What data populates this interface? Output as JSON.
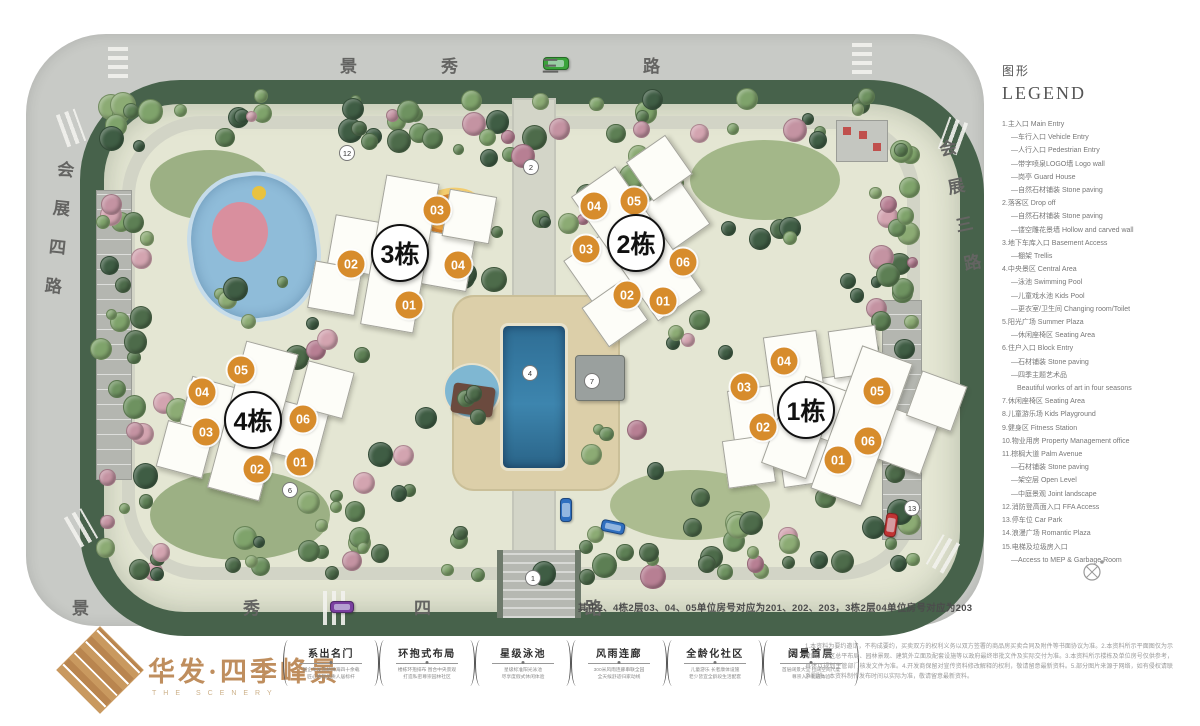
{
  "colors": {
    "road_gray": "#c8cac6",
    "tree_band_green": "#47624b",
    "ground": "#e4e6d3",
    "unit_orange": "#d78c2c",
    "pool_blue": "#2e6d94",
    "brand_gold": "#bf8e5e"
  },
  "map": {
    "roads": {
      "top": [
        "景",
        "秀",
        "三",
        "路"
      ],
      "bottom": [
        "景",
        "秀",
        "四",
        "路"
      ],
      "left": "会展四路",
      "right": "会展三路"
    },
    "note": "其中2、4栋2层03、04、05单位房号对应为201、202、203，3栋2层04单位房号对应为203",
    "buildings": [
      {
        "name": "3栋",
        "x": 400,
        "y": 253,
        "units": [
          {
            "n": "03",
            "x": 437,
            "y": 210
          },
          {
            "n": "02",
            "x": 351,
            "y": 264
          },
          {
            "n": "04",
            "x": 458,
            "y": 265
          },
          {
            "n": "01",
            "x": 409,
            "y": 305
          }
        ]
      },
      {
        "name": "2栋",
        "x": 636,
        "y": 243,
        "units": [
          {
            "n": "04",
            "x": 594,
            "y": 206
          },
          {
            "n": "05",
            "x": 634,
            "y": 201
          },
          {
            "n": "03",
            "x": 586,
            "y": 249
          },
          {
            "n": "06",
            "x": 683,
            "y": 262
          },
          {
            "n": "02",
            "x": 627,
            "y": 295
          },
          {
            "n": "01",
            "x": 663,
            "y": 301
          }
        ]
      },
      {
        "name": "1栋",
        "x": 806,
        "y": 410,
        "units": [
          {
            "n": "04",
            "x": 784,
            "y": 361
          },
          {
            "n": "03",
            "x": 744,
            "y": 387
          },
          {
            "n": "05",
            "x": 877,
            "y": 391
          },
          {
            "n": "02",
            "x": 763,
            "y": 427
          },
          {
            "n": "06",
            "x": 868,
            "y": 441
          },
          {
            "n": "01",
            "x": 838,
            "y": 460
          }
        ]
      },
      {
        "name": "4栋",
        "x": 253,
        "y": 420,
        "units": [
          {
            "n": "05",
            "x": 241,
            "y": 370
          },
          {
            "n": "04",
            "x": 202,
            "y": 392
          },
          {
            "n": "06",
            "x": 303,
            "y": 419
          },
          {
            "n": "03",
            "x": 206,
            "y": 432
          },
          {
            "n": "02",
            "x": 257,
            "y": 469
          },
          {
            "n": "01",
            "x": 300,
            "y": 462
          }
        ]
      }
    ],
    "path_markers": [
      {
        "n": "12",
        "x": 347,
        "y": 153
      },
      {
        "n": "2",
        "x": 531,
        "y": 167
      },
      {
        "n": "4",
        "x": 530,
        "y": 373
      },
      {
        "n": "7",
        "x": 592,
        "y": 381
      },
      {
        "n": "6",
        "x": 290,
        "y": 490
      },
      {
        "n": "1",
        "x": 533,
        "y": 578
      },
      {
        "n": "13",
        "x": 912,
        "y": 508
      }
    ]
  },
  "legend": {
    "title_zh": "图形",
    "title_en": "LEGEND",
    "lines": [
      {
        "t": "1.主入口 Main Entry",
        "l": 0
      },
      {
        "t": "—车行入口 Vehicle Entry",
        "l": 1
      },
      {
        "t": "—人行入口 Pedestrian Entry",
        "l": 1
      },
      {
        "t": "—带字喷泉LOGO墙 Logo wall",
        "l": 1
      },
      {
        "t": "—岗亭 Guard House",
        "l": 1
      },
      {
        "t": "—自然石材铺装 Stone paving",
        "l": 1
      },
      {
        "t": "2.落客区 Drop off",
        "l": 0
      },
      {
        "t": "—自然石材铺装 Stone paving",
        "l": 1
      },
      {
        "t": "—镂空雕花景墙 Hollow and carved wall",
        "l": 1
      },
      {
        "t": "3.地下车库入口 Basement Access",
        "l": 0
      },
      {
        "t": "—棚架 Trellis",
        "l": 1
      },
      {
        "t": "4.中央景区 Central Area",
        "l": 0
      },
      {
        "t": "—泳池 Swimming Pool",
        "l": 1
      },
      {
        "t": "—儿童戏水池 Kids Pool",
        "l": 1
      },
      {
        "t": "—更衣室/卫生间 Changing room/Toilet",
        "l": 1
      },
      {
        "t": "5.阳光广场 Summer Plaza",
        "l": 0
      },
      {
        "t": "—休闲座椅区 Seating Area",
        "l": 1
      },
      {
        "t": "6.住户入口 Block Entry",
        "l": 0
      },
      {
        "t": "—石材铺装 Stone paving",
        "l": 1
      },
      {
        "t": "—四季主题艺术品",
        "l": 1
      },
      {
        "t": "Beautiful works of art in four seasons",
        "l": 2
      },
      {
        "t": "7.休闲座椅区 Seating Area",
        "l": 0
      },
      {
        "t": "8.儿童游乐场 Kids Playground",
        "l": 0
      },
      {
        "t": "9.健身区 Fitness Station",
        "l": 0
      },
      {
        "t": "10.物业用房 Property Management office",
        "l": 0
      },
      {
        "t": "11.棕榈大道 Palm Avenue",
        "l": 0
      },
      {
        "t": "—石材铺装 Stone paving",
        "l": 1
      },
      {
        "t": "—架空层 Open Level",
        "l": 1
      },
      {
        "t": "—中庭景观 Joint landscape",
        "l": 1
      },
      {
        "t": "12.消防登高面入口 FFA Access",
        "l": 0
      },
      {
        "t": "13.停车位 Car Park",
        "l": 0
      },
      {
        "t": "14.浪漫广场 Romantic Plaza",
        "l": 0
      },
      {
        "t": "15.电梯及垃圾房入口",
        "l": 0
      },
      {
        "t": "—Access to MEP & Garbage Room",
        "l": 1
      }
    ]
  },
  "footer": {
    "brand_title": "华发·四季峰景",
    "brand_sub": "THE SCENERY",
    "features": [
      {
        "title": "系出名门",
        "d1": "国企华发深耕珠海四十余载",
        "d2": "匠心铸就品质人居标杆"
      },
      {
        "title": "环抱式布局",
        "d1": "楼栋环抱排布 围合中央景观",
        "d2": "打造私密尊崇园林社区"
      },
      {
        "title": "星级泳池",
        "d1": "星级标准阳光泳池",
        "d2": "尽享度假式休闲体验"
      },
      {
        "title": "风雨连廊",
        "d1": "300米风雨连廊串联全园",
        "d2": "全天候舒适归家动线"
      },
      {
        "title": "全龄化社区",
        "d1": "儿童游乐 长者康体设施",
        "d2": "老少皆宜全龄段生活配套"
      },
      {
        "title": "阔景首层",
        "d1": "首层阔景大堂 拉阔空间尺度",
        "d2": "尊崇入户礼遇体验"
      }
    ],
    "disclaimer": "1.本资料为要约邀请，不构成要约，买卖双方的权利义务以双方签署的商品房买卖合同及附件等书面协议为准。2.本资料所示平面图仅为示意图，小区总平布局、园林景观、建筑外立面及配套设施等以政府最终审批文件及实际交付为准。3.本资料所示楼栋及单位房号仅供参考，具体以规划主管部门核发文件为准。4.开发商保留对宣传资料修改解释的权利，敬请留意最新资料。5.部分图片来源于网络，如有侵权请联系删除，本资料制作发布时间以实际为准，敬请留意最新资料。"
  }
}
